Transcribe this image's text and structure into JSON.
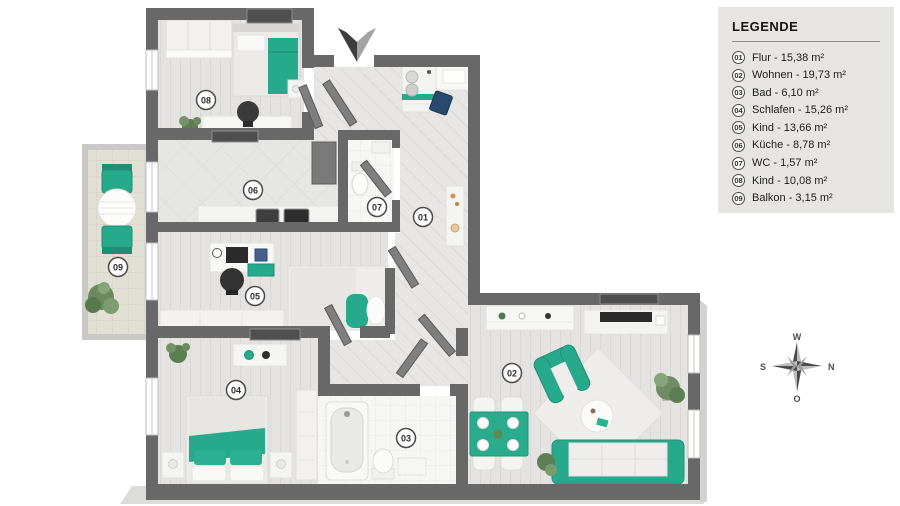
{
  "legend": {
    "title": "LEGENDE",
    "items": [
      {
        "number": "01",
        "label": "Flur - 15,38 m²"
      },
      {
        "number": "02",
        "label": "Wohnen - 19,73 m²"
      },
      {
        "number": "03",
        "label": "Bad - 6,10 m²"
      },
      {
        "number": "04",
        "label": "Schlafen - 15,26 m²"
      },
      {
        "number": "05",
        "label": "Kind - 13,66 m²"
      },
      {
        "number": "06",
        "label": "Küche - 8,78 m²"
      },
      {
        "number": "07",
        "label": "WC - 1,57 m²"
      },
      {
        "number": "08",
        "label": "Kind - 10,08 m²"
      },
      {
        "number": "09",
        "label": "Balkon - 3,15 m²"
      }
    ]
  },
  "compass": {
    "top": "W",
    "right": "N",
    "left": "S",
    "bottom": "O"
  },
  "colors": {
    "accent_teal": "#27a98b",
    "wall_gray": "#686868",
    "legend_bg": "#e6e5e3"
  }
}
